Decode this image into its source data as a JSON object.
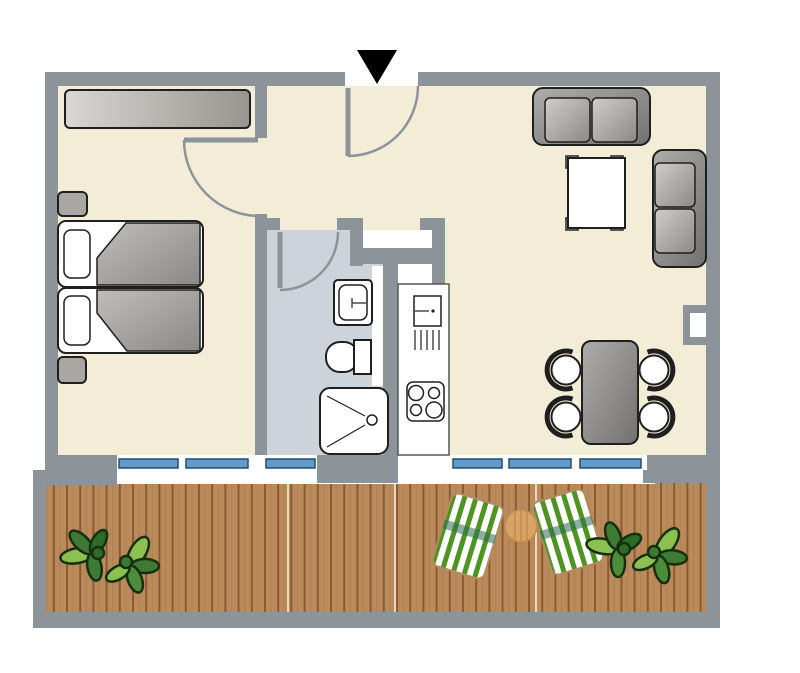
{
  "image": {
    "kind": "apartment floor plan, top-down view",
    "visible_text": "none",
    "entrance_marker": "black triangle pointing down at entrance door in top wall"
  },
  "rooms": [
    {
      "name": "bedroom",
      "position": "top-left"
    },
    {
      "name": "hallway",
      "position": "center-top"
    },
    {
      "name": "bathroom",
      "position": "center",
      "floor": "light blue-gray tile"
    },
    {
      "name": "kitchen-niche",
      "position": "center, east of bathroom"
    },
    {
      "name": "living-dining-area",
      "position": "right"
    },
    {
      "name": "balcony",
      "position": "bottom, full width",
      "floor": "wood decking"
    }
  ],
  "furniture": {
    "bedroom": [
      "wardrobe",
      "double-bed-two-mattresses",
      "pillow-left",
      "pillow-right",
      "blanket-left",
      "blanket-right",
      "nightstand-top",
      "nightstand-bottom"
    ],
    "bathroom": [
      "washbasin",
      "toilet",
      "shower"
    ],
    "kitchen": [
      "counter",
      "sink-unit-with-faucet-dot",
      "drainer-5-lines",
      "cooktop-4-burners"
    ],
    "living": [
      "sofa-two-seat-top-wall",
      "sofa-two-seat-right-wall",
      "coffee-table-4-feet",
      "dining-table",
      "dining-chairs-x4"
    ],
    "balcony": [
      "plant-left",
      "plant-right",
      "deck-chair-left",
      "deck-chair-right",
      "round-side-table"
    ]
  },
  "doors": [
    {
      "name": "entrance-door",
      "wall": "top",
      "swing": "inward-left"
    },
    {
      "name": "bedroom-door",
      "swing": "into-bedroom"
    },
    {
      "name": "bathroom-door",
      "swing": "into-bathroom"
    }
  ],
  "windows": {
    "total_panes": 6,
    "bands": [
      {
        "location": "bedroom-bathroom south wall",
        "panes": 3
      },
      {
        "location": "living-room south wall",
        "panes": 3
      }
    ]
  },
  "counts": {
    "dining_chairs": 4,
    "cooktop_burners": 4,
    "deck_chairs": 2,
    "plants": 2,
    "sofas": 2
  },
  "colors": {
    "wall": "#8d9499",
    "floor_cream": "#f3ecd7",
    "bathroom_floor": "#ccd3da",
    "window_glass": "#649ac8",
    "window_frame_dark": "#1f4e79",
    "deck_wood": "#bb8a5b",
    "deck_plank_line": "#8a5a33",
    "furniture_outline": "#1f1f1f",
    "furniture_gray_light": "#cfcecb",
    "furniture_gray_dark": "#727170",
    "plant_light_green": "#8cc152",
    "plant_dark_green": "#3e7a35",
    "lounger_stripe_green": "#4e9420",
    "side_table_wood": "#d9a266",
    "entrance_marker": "#000000"
  }
}
